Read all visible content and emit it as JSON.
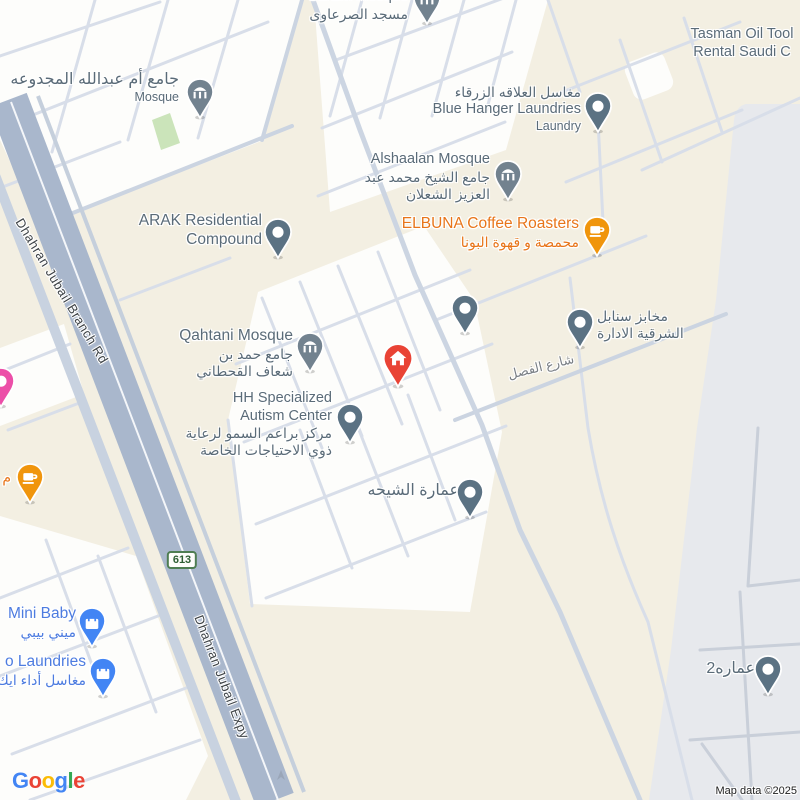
{
  "map": {
    "background": "#F3EFE2",
    "attribution": "Map data ©2025"
  },
  "logo": {
    "letters": [
      {
        "ch": "G",
        "color": "#4285F4"
      },
      {
        "ch": "o",
        "color": "#EA4335"
      },
      {
        "ch": "o",
        "color": "#FBBC05"
      },
      {
        "ch": "g",
        "color": "#4285F4"
      },
      {
        "ch": "l",
        "color": "#34A853"
      },
      {
        "ch": "e",
        "color": "#EA4335"
      }
    ]
  },
  "route_shield": {
    "text": "613",
    "x": 182,
    "y": 560
  },
  "road_labels": [
    {
      "text": "Dhahran Jubail Branch Rd",
      "x": 62,
      "y": 291,
      "rot": 59,
      "gray": false
    },
    {
      "text": "Dhahran Jubail Expy",
      "x": 222,
      "y": 677,
      "rot": 69,
      "gray": false
    },
    {
      "text": "شارع الفصل",
      "x": 541,
      "y": 367,
      "rot": -14,
      "gray": true
    }
  ],
  "colors": {
    "poi_text": "#5A6B78",
    "food_text": "#E8751A",
    "shop_text": "#4D7CE0",
    "pin_generic": "#5B7283",
    "pin_mosque": "#72828F",
    "pin_home": "#E94335",
    "pin_coffee": "#F0950C",
    "pin_shop": "#4285F4",
    "pin_pink": "#EC4FA8",
    "road_major": "#A9B7CC",
    "land_gray": "#E7E9ED",
    "land_white": "#FDFDFB",
    "park_green": "#CBE4BA"
  },
  "pois": [
    {
      "id": "umm-abdullah-mosque",
      "style": "mosque",
      "pin": {
        "x": 200,
        "y": 92
      },
      "label": {
        "x": 179,
        "y": 70,
        "align": "right"
      },
      "lines": [
        {
          "text": "جامع أم عبدالله المجدوعه",
          "cls": "ar lg"
        },
        {
          "text": "Mosque",
          "cls": "sub"
        }
      ]
    },
    {
      "id": "sarawi-mosque",
      "style": "mosque",
      "pin": {
        "x": 427,
        "y": -2
      },
      "label": {
        "x": 408,
        "y": -12,
        "align": "right"
      },
      "lines": [
        {
          "text": "Sarawi Mosque",
          "cls": "en"
        },
        {
          "text": "مسجد الصرعاوى",
          "cls": "ar"
        }
      ]
    },
    {
      "id": "blue-hanger-laundries",
      "style": "generic",
      "pin": {
        "x": 598,
        "y": 106
      },
      "label": {
        "x": 581,
        "y": 84,
        "align": "right"
      },
      "lines": [
        {
          "text": "مغاسل العلاقه الزرقاء",
          "cls": "ar"
        },
        {
          "text": "Blue Hanger Laundries",
          "cls": "en"
        },
        {
          "text": "Laundry",
          "cls": "sub"
        }
      ]
    },
    {
      "id": "tasman-oil-tools",
      "style": "none",
      "pin": null,
      "label": {
        "x": 672,
        "y": 26,
        "align": "center",
        "w": 140
      },
      "lines": [
        {
          "text": "Tasman Oil Tool",
          "cls": "en"
        },
        {
          "text": "Rental Saudi C",
          "cls": "en"
        }
      ]
    },
    {
      "id": "alshaalan-mosque",
      "style": "mosque",
      "pin": {
        "x": 508,
        "y": 174
      },
      "label": {
        "x": 490,
        "y": 151,
        "align": "right"
      },
      "lines": [
        {
          "text": "Alshaalan Mosque",
          "cls": "en"
        },
        {
          "text": "جامع الشيخ محمد عبد",
          "cls": "ar"
        },
        {
          "text": "العزيز الشعلان",
          "cls": "ar"
        }
      ]
    },
    {
      "id": "elbuna-coffee-roasters",
      "style": "coffee",
      "pin": {
        "x": 597,
        "y": 230
      },
      "label": {
        "x": 579,
        "y": 215,
        "align": "right"
      },
      "lines": [
        {
          "text": "ELBUNA Coffee Roasters",
          "cls": "en lg c-food"
        },
        {
          "text": "محمصة و قهوة البونا",
          "cls": "ar c-food"
        }
      ]
    },
    {
      "id": "arak-residential-compound",
      "style": "generic",
      "pin": {
        "x": 278,
        "y": 232
      },
      "label": {
        "x": 262,
        "y": 212,
        "align": "right"
      },
      "lines": [
        {
          "text": "ARAK Residential",
          "cls": "en lg"
        },
        {
          "text": "Compound",
          "cls": "en lg"
        }
      ]
    },
    {
      "id": "qahtani-mosque",
      "style": "mosque",
      "pin": {
        "x": 310,
        "y": 346
      },
      "label": {
        "x": 293,
        "y": 327,
        "align": "right"
      },
      "lines": [
        {
          "text": "Qahtani Mosque",
          "cls": "en lg"
        },
        {
          "text": "جامع حمد بن",
          "cls": "ar"
        },
        {
          "text": "شعاف القحطاني",
          "cls": "ar"
        }
      ]
    },
    {
      "id": "hh-specialized-autism-center",
      "style": "generic",
      "pin": {
        "x": 350,
        "y": 417
      },
      "label": {
        "x": 332,
        "y": 390,
        "align": "right"
      },
      "lines": [
        {
          "text": "HH Specialized",
          "cls": "en"
        },
        {
          "text": "Autism Center",
          "cls": "en"
        },
        {
          "text": "مركز براعم السمو لرعاية",
          "cls": "ar"
        },
        {
          "text": "ذوي الاحتياجات الخاصة",
          "cls": "ar"
        }
      ]
    },
    {
      "id": "home-marker",
      "style": "home",
      "pin": {
        "x": 398,
        "y": 359
      },
      "label": null,
      "lines": []
    },
    {
      "id": "unlabeled-place",
      "style": "generic",
      "pin": {
        "x": 465,
        "y": 308
      },
      "label": null,
      "lines": []
    },
    {
      "id": "sanabel-bakeries",
      "style": "generic",
      "pin": {
        "x": 580,
        "y": 322
      },
      "label": {
        "x": 597,
        "y": 308,
        "align": "left"
      },
      "lines": [
        {
          "text": "مخابز سنابل",
          "cls": "ar"
        },
        {
          "text": "الشرقية الادارة",
          "cls": "ar"
        }
      ]
    },
    {
      "id": "amarat-al-shiha",
      "style": "generic",
      "pin": {
        "x": 470,
        "y": 492
      },
      "label": {
        "x": 459,
        "y": 481,
        "align": "right"
      },
      "lines": [
        {
          "text": "عمارة الشيحه",
          "cls": "ar lg"
        }
      ]
    },
    {
      "id": "mini-baby",
      "style": "shop",
      "pin": {
        "x": 92,
        "y": 621
      },
      "label": {
        "x": 76,
        "y": 605,
        "align": "right"
      },
      "lines": [
        {
          "text": "Mini Baby",
          "cls": "en lg c-shop"
        },
        {
          "text": "ميني بيبي",
          "cls": "ar c-shop"
        }
      ]
    },
    {
      "id": "laundries",
      "style": "shop",
      "pin": {
        "x": 103,
        "y": 671
      },
      "label": {
        "x": 86,
        "y": 653,
        "align": "right"
      },
      "lines": [
        {
          "text": "o Laundries",
          "cls": "en lg c-shop"
        },
        {
          "text": "مغاسل أداء ايك",
          "cls": "ar c-shop"
        }
      ]
    },
    {
      "id": "amara2",
      "style": "generic",
      "pin": {
        "x": 768,
        "y": 669
      },
      "label": {
        "x": 755,
        "y": 659,
        "align": "right"
      },
      "lines": [
        {
          "text": "عماره2",
          "cls": "ar lg"
        }
      ]
    },
    {
      "id": "pink-place",
      "style": "pink",
      "pin": {
        "x": 1,
        "y": 381
      },
      "label": null,
      "lines": []
    },
    {
      "id": "coffee-left-edge",
      "style": "coffee",
      "pin": {
        "x": 30,
        "y": 477
      },
      "label": {
        "x": 11,
        "y": 469,
        "align": "right"
      },
      "lines": [
        {
          "text": "م",
          "cls": "ar c-food"
        }
      ]
    }
  ]
}
